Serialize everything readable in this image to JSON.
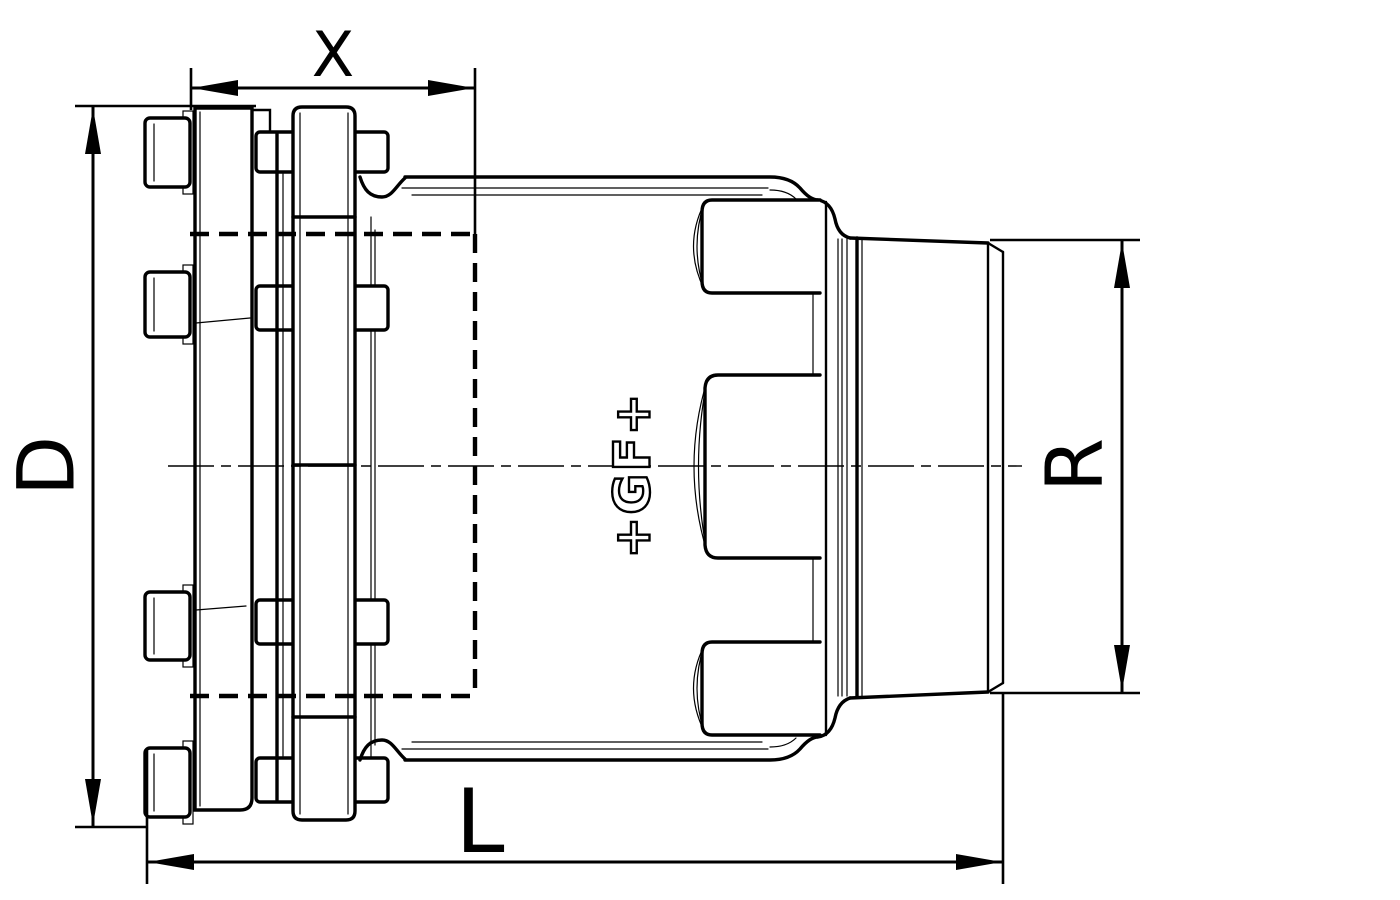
{
  "drawing": {
    "background_color": "#ffffff",
    "line_color": "#000000",
    "logo_text": "+GF+",
    "dimension_labels": {
      "insertion_depth_top": "X",
      "flange_diameter_left": "D",
      "pipe_diameter_right": "R",
      "overall_length_bottom": "L"
    }
  }
}
